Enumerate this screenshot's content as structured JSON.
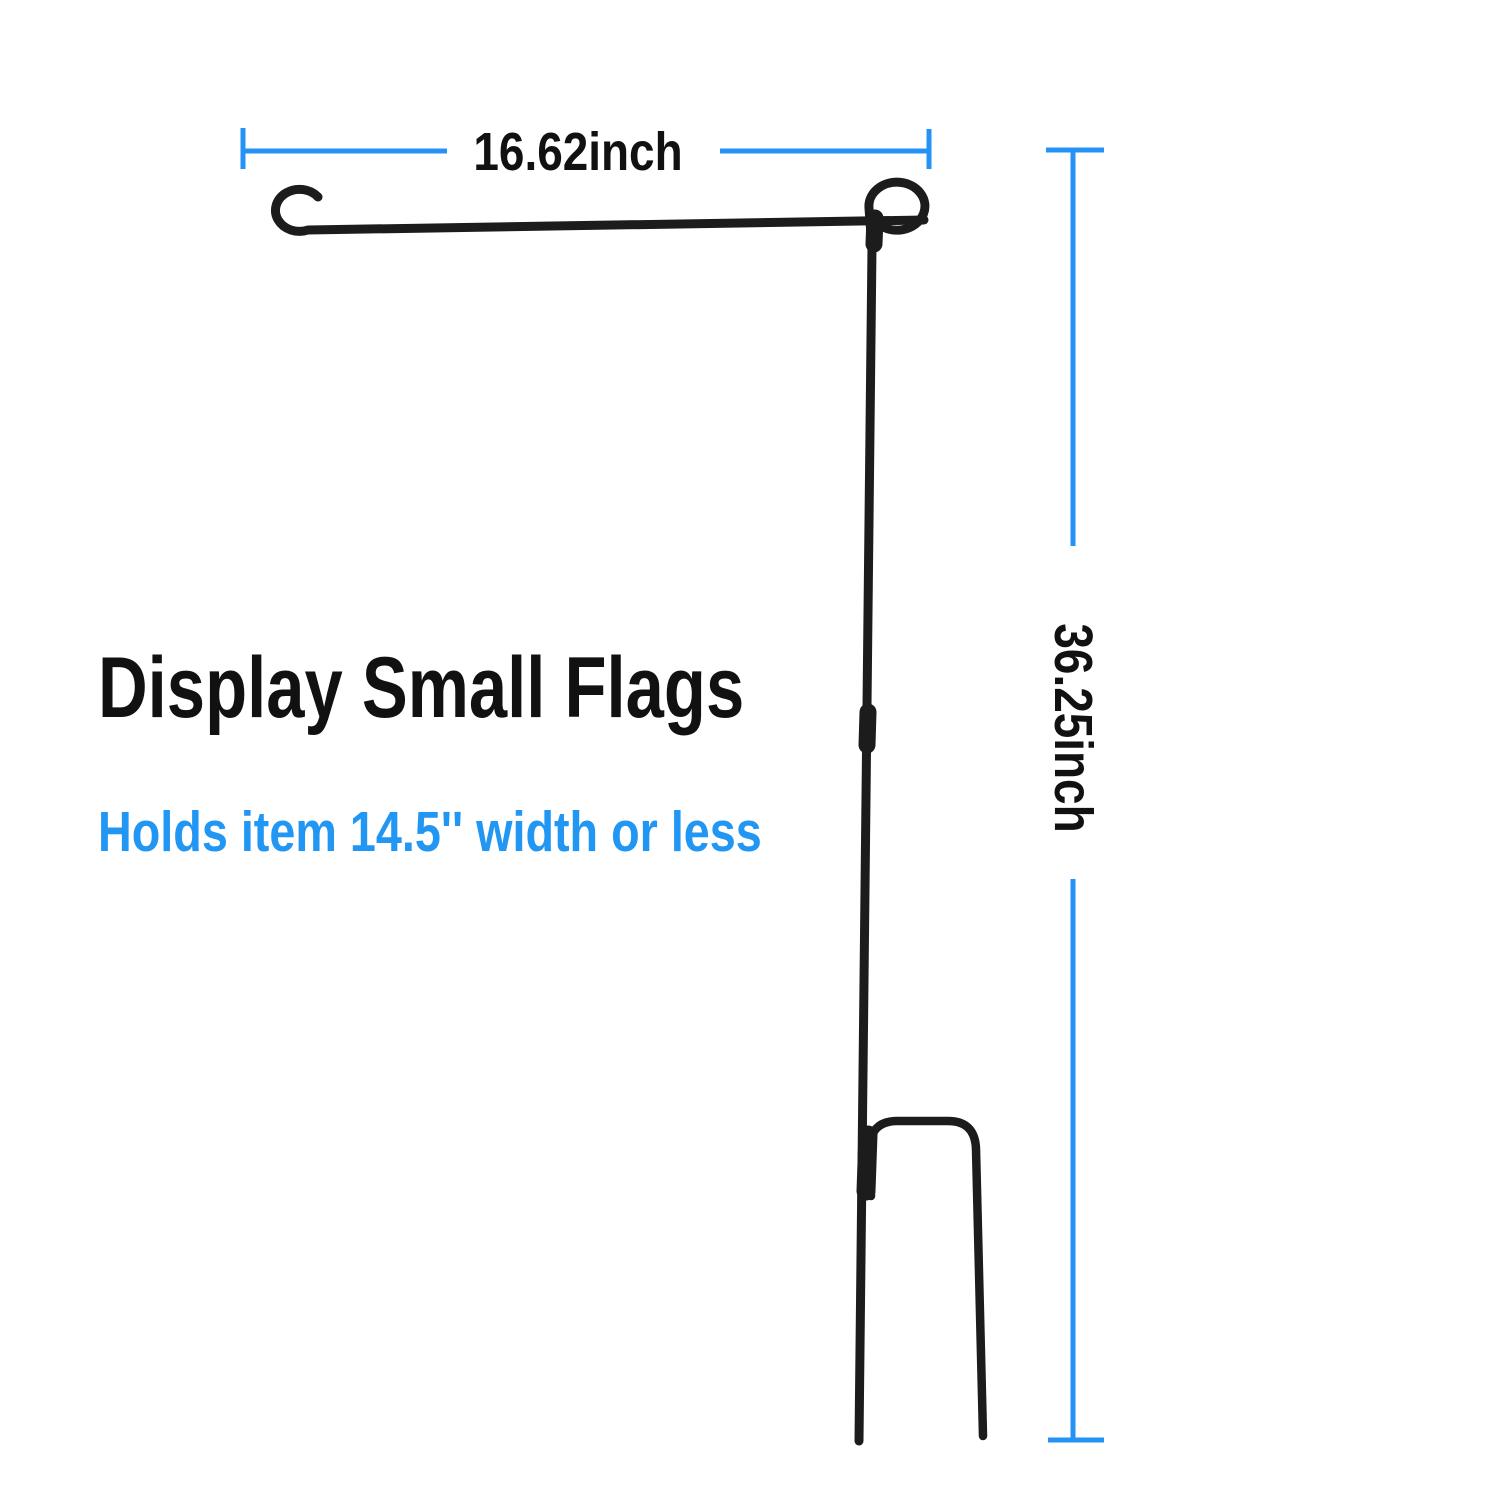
{
  "page": {
    "background": "#ffffff",
    "description": "Product dimension diagram of a black metal garden flag stand"
  },
  "product": {
    "name": "garden-flag-stand",
    "rod_color": "#1c1c1c",
    "parts": {
      "arm": "horizontal flag arm with end hook",
      "loop": "top retaining loop",
      "pole": "two-section vertical pole",
      "connector": "mid pole connector sleeve",
      "fork": "two-prong ground stake fork"
    }
  },
  "dimensions": {
    "line_color": "#2493f5",
    "text_color": "#111111",
    "width": {
      "label": "16.62inch"
    },
    "height": {
      "label": "36.25inch"
    }
  },
  "captions": {
    "title": "Display Small Flags",
    "title_color": "#111111",
    "subtitle": "Holds item 14.5'' width or less",
    "subtitle_color": "#2196f3"
  }
}
